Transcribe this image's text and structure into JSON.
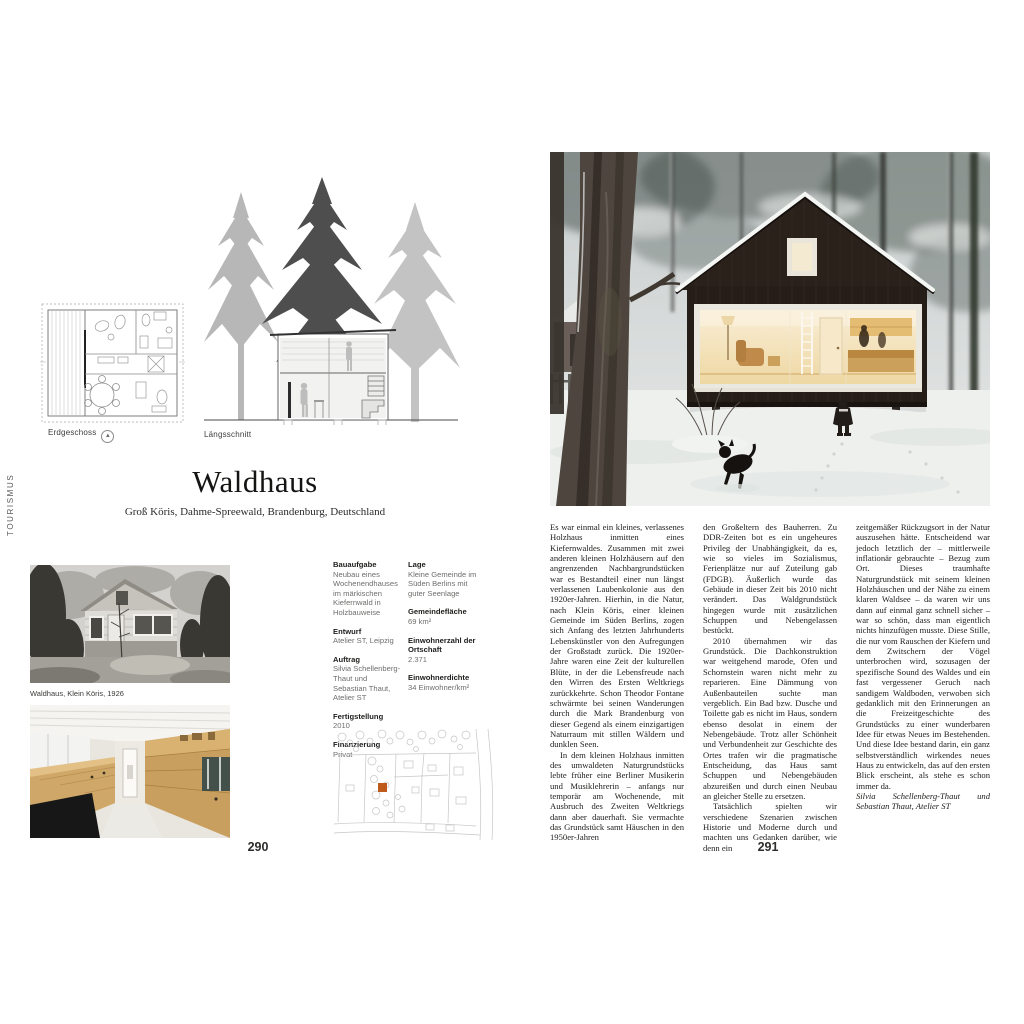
{
  "page": {
    "section_label": "TOURISMUS",
    "left_number": "290",
    "right_number": "291"
  },
  "title": {
    "name": "Waldhaus",
    "location": "Groß Köris, Dahme-Spreewald, Brandenburg, Deutschland"
  },
  "drawings": {
    "plan_caption": "Erdgeschoss",
    "north_icon": "north-arrow-icon",
    "north_glyph": "▲",
    "section_caption": "Längsschnitt"
  },
  "photos": {
    "historic_caption": "Waldhaus, Klein Köris, 1926"
  },
  "facts": {
    "left": [
      {
        "label": "Bauaufgabe",
        "value": "Neubau eines Wochenendhauses im märkischen Kiefern­wald in Holzbauweise"
      },
      {
        "label": "Entwurf",
        "value": "Atelier ST, Leipzig"
      },
      {
        "label": "Auftrag",
        "value": "Silvia Schellenberg-Thaut und Sebastian Thaut, Atelier ST"
      },
      {
        "label": "Fertigstellung",
        "value": "2010"
      },
      {
        "label": "Finanzierung",
        "value": "Privat"
      }
    ],
    "right": [
      {
        "label": "Lage",
        "value": "Kleine Gemeinde im Süden Berlins mit guter Seenlage"
      },
      {
        "label": "Gemeindefläche",
        "value": "69 km²"
      },
      {
        "label": "Einwohnerzahl der Ortschaft",
        "value": "2.371"
      },
      {
        "label": "Einwohnerdichte",
        "value": "34 Einwohner/km²"
      }
    ]
  },
  "article": {
    "col1": [
      "Es war einmal ein kleines, verlassenes Holzhaus inmitten eines Kiefernwaldes. Zusammen mit zwei anderen kleinen Holzhäusern auf den angrenzenden Nachbargrundstücken war es Bestandteil einer nun längst verlassenen Laubenkolonie aus den 1920er-Jahren. Hierhin, in die Natur, nach Klein Köris, einer kleinen Gemeinde im Süden Berlins, zogen sich Anfang des letzten Jahrhunderts Lebenskünstler von den Aufregungen der Großstadt zurück. Die 1920er-Jahre waren eine Zeit der kulturellen Blüte, in der die Lebensfreude nach den Wirren des Ersten Weltkriegs zurückkehrte. Schon Theodor Fontane schwärmte bei seinen Wanderungen durch die Mark Brandenburg von dieser Gegend als einem einzigartigen Naturraum mit stillen Wäldern und dunklen Seen.",
      "In dem kleinen Holzhaus inmitten des umwaldeten Naturgrundstücks lebte früher eine Berliner Musikerin und Musiklehrerin – anfangs nur temporär am Wochenende, mit Ausbruch des Zweiten Weltkriegs dann aber dauerhaft. Sie vermachte das Grundstück samt Häuschen in den 1950er-Jahren"
    ],
    "col2": [
      "den Großeltern des Bauherren. Zu DDR-Zeiten bot es ein ungeheures Privileg der Unabhängigkeit, da es, wie so vieles im Sozialismus, Ferienplätze nur auf Zuteilung gab (FDGB). Äußerlich wurde das Gebäude in dieser Zeit bis 2010 nicht verändert. Das Waldgrundstück hingegen wurde mit zusätzlichen Schuppen und Nebengelassen bestückt.",
      "2010 übernahmen wir das Grundstück. Die Dachkonstruktion war weitgehend marode, Ofen und Schornstein waren nicht mehr zu reparieren. Eine Dämmung von Außenbauteilen suchte man vergeblich. Ein Bad bzw. Dusche und Toilette gab es nicht im Haus, sondern ebenso desolat in einem der Nebengebäude. Trotz aller Schönheit und Verbundenheit zur Geschichte des Ortes trafen wir die pragmatische Entscheidung, das Haus samt Schuppen und Nebengebäuden abzureißen und durch einen Neubau an gleicher Stelle zu ersetzen.",
      "Tatsächlich spielten wir verschiedene Szenarien zwischen Historie und Moderne durch und machten uns Gedanken darüber, wie denn ein"
    ],
    "col3": [
      "zeitgemäßer Rückzugsort in der Natur auszusehen hätte. Entscheidend war jedoch letztlich der – mittlerweile inflationär gebrauchte – Bezug zum Ort. Dieses traumhafte Naturgrundstück mit seinem kleinen Holzhäuschen und der Nähe zu einem klaren Waldsee – da waren wir uns dann auf einmal ganz schnell sicher – war so schön, dass man eigentlich nichts hinzufügen musste. Diese Stille, die nur vom Rauschen der Kiefern und dem Zwitschern der Vögel unterbrochen wird, sozusagen der spezifische Sound des Waldes und ein fast vergessener Geruch nach sandigem Waldboden, verwoben sich gedanklich mit den Erinnerungen an die Freizeitgeschichte des Grundstücks zu einer wunderbaren Idee für etwas Neues im Bestehenden. Und diese Idee bestand darin, ein ganz selbstverständlich wirkendes neues Haus zu entwickeln, das auf den ersten Blick erscheint, als stehe es schon immer da."
    ],
    "attribution": "Silvia Schellenberg-Thaut und Sebastian Thaut, Atelier ST"
  },
  "colors": {
    "site_marker_accent": "#bf5a1d",
    "cabin_dark": "#2a211b",
    "window_glow": "#f3e2b4",
    "drawing_gray": "#b7b7b7",
    "tree_dark_gray": "#4e4e4e"
  }
}
